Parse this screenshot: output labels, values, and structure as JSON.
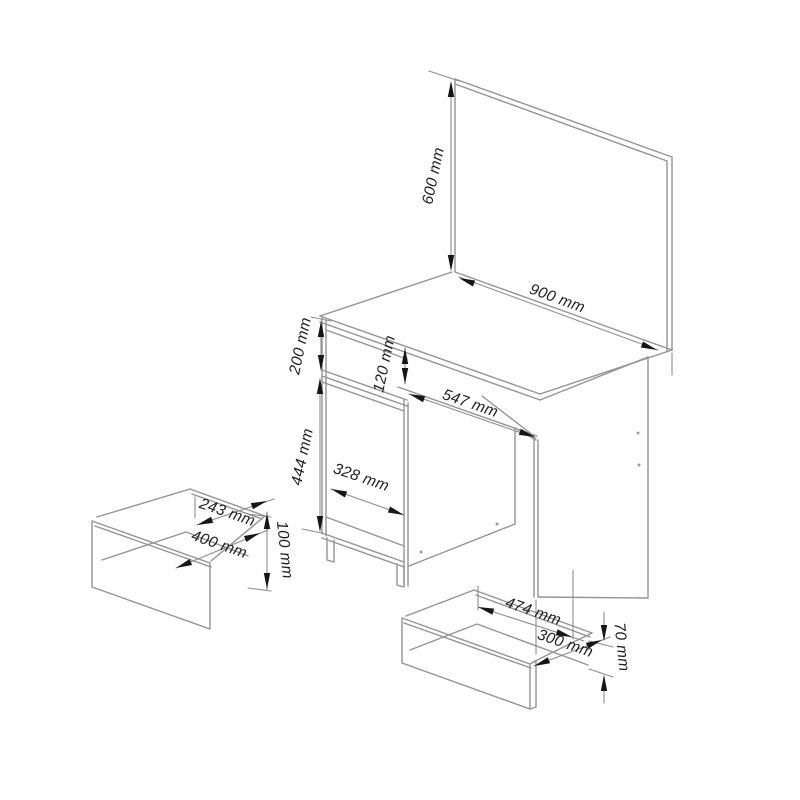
{
  "diagram": {
    "kind": "furniture-technical-drawing",
    "subject": "dressing table with mirror, kneehole desk and two pull-out drawers",
    "unit": "mm",
    "colors": {
      "background": "#ffffff",
      "outline": "#949494",
      "dimension_line": "#8e8e8e",
      "arrow": "#161616",
      "text": "#1f1f1f"
    },
    "dimensions": {
      "mirror_height": "600 mm",
      "mirror_width": "900 mm",
      "top_section_height": "200 mm",
      "front_drawer_height": "120 mm",
      "kneehole_width": "547 mm",
      "door_height": "444 mm",
      "door_width": "328 mm",
      "left_drawer_depth": "243 mm",
      "left_drawer_width": "400 mm",
      "left_drawer_height": "100 mm",
      "right_drawer_width": "474 mm",
      "right_drawer_depth": "300 mm",
      "right_drawer_height": "70 mm"
    }
  }
}
